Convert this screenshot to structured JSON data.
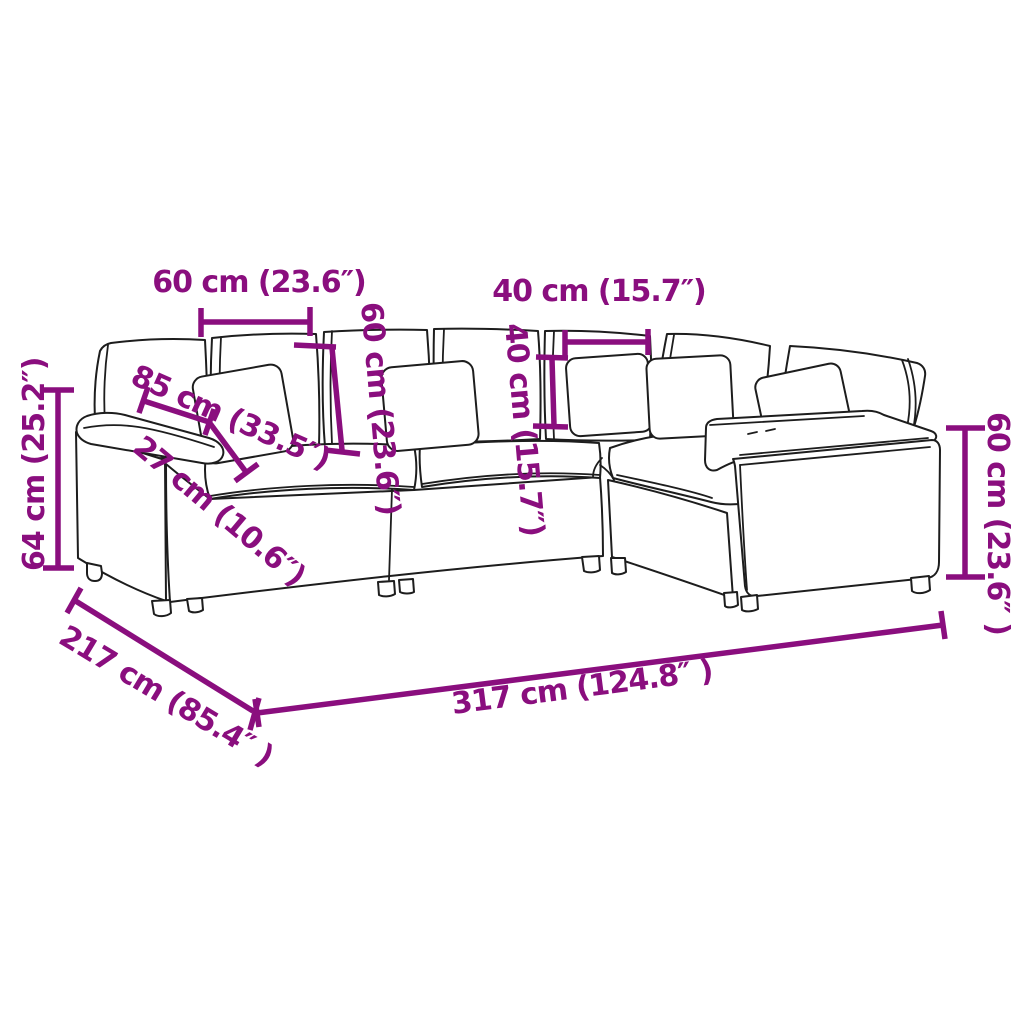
{
  "image": {
    "kind": "product dimension diagram",
    "subject": "modular corner sofa outline drawing with measurements",
    "background": "#FFFFFF"
  },
  "colors": {
    "annotation": "#8A0E7E",
    "outline": "#1D1D1D"
  },
  "dimensions": {
    "back_cushion_width": "60 cm (23.6″)",
    "pillow_width": "40 cm (15.7″)",
    "seat_depth": "85 cm (33.5″)",
    "armrest_width": "27 cm (10.6″)",
    "back_cushion_height": "60 cm (23.6″)",
    "pillow_height": "40 cm (15.7″)",
    "left_height": "64 cm (25.2″)",
    "right_height": "60 cm (23.6″ )",
    "total_depth": "217 cm (85.4″ )",
    "total_width": "317 cm (124.8″ )"
  }
}
